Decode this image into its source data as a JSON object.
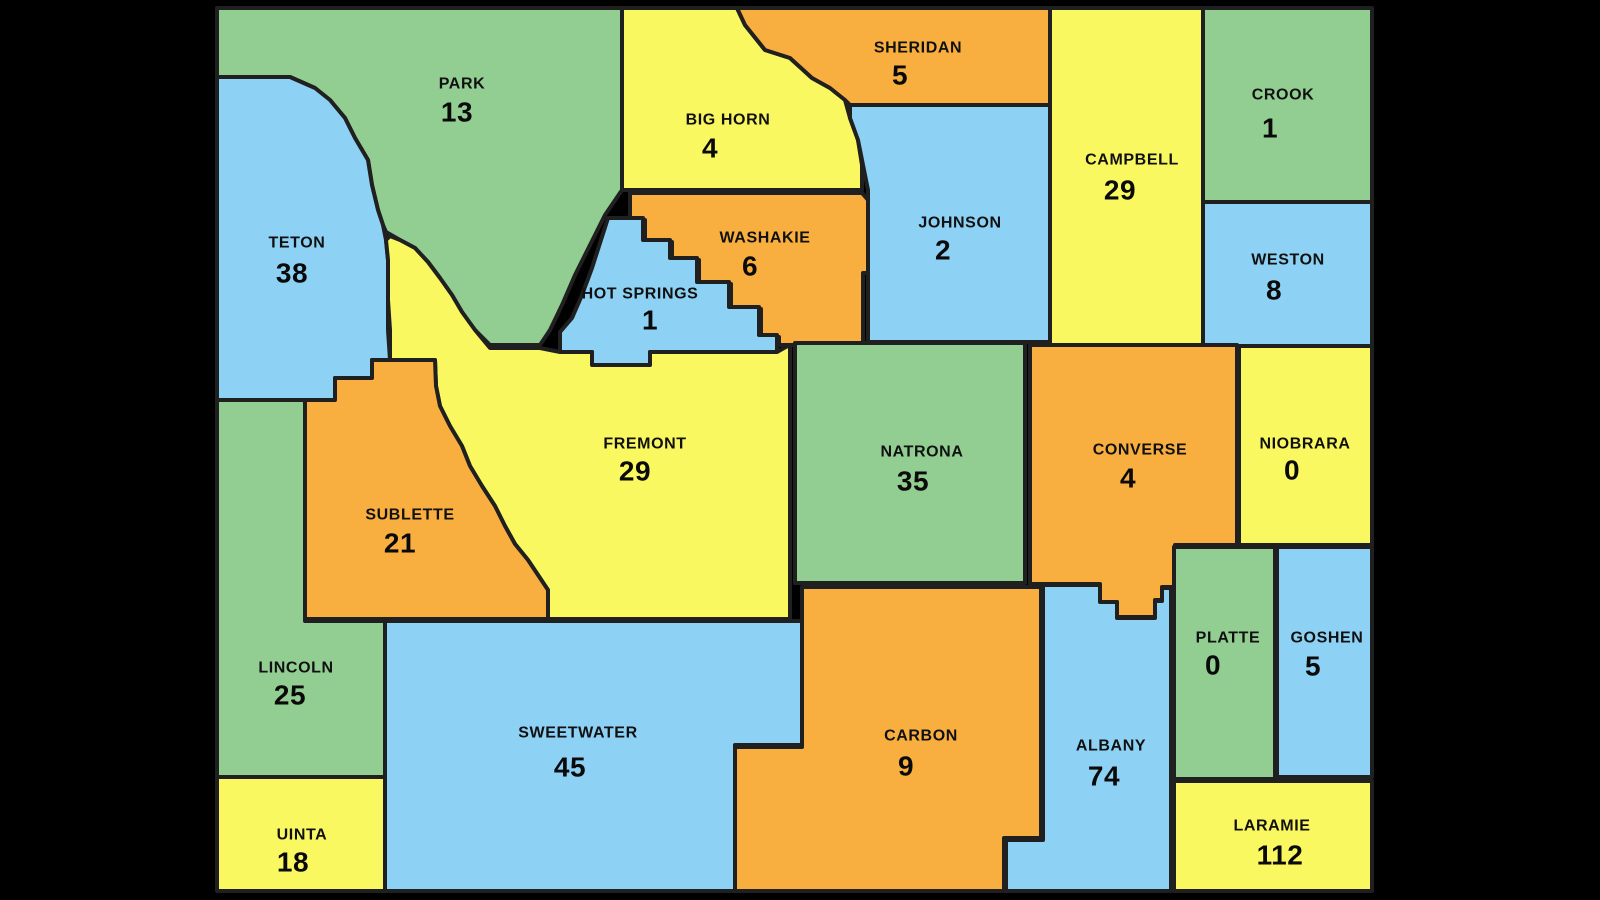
{
  "map": {
    "region": "Wyoming county map",
    "palette": {
      "green": "#92CD92",
      "yellow": "#FAF860",
      "blue": "#8DD1F5",
      "orange": "#F9AF40",
      "border": "#202020",
      "background": "#000000",
      "label": "#101010"
    },
    "counties": [
      {
        "id": "park",
        "name": "PARK",
        "value": "13",
        "color": "green"
      },
      {
        "id": "big-horn",
        "name": "BIG HORN",
        "value": "4",
        "color": "yellow"
      },
      {
        "id": "sheridan",
        "name": "SHERIDAN",
        "value": "5",
        "color": "orange"
      },
      {
        "id": "campbell",
        "name": "CAMPBELL",
        "value": "29",
        "color": "yellow"
      },
      {
        "id": "crook",
        "name": "CROOK",
        "value": "1",
        "color": "green"
      },
      {
        "id": "teton",
        "name": "TETON",
        "value": "38",
        "color": "blue"
      },
      {
        "id": "washakie",
        "name": "WASHAKIE",
        "value": "6",
        "color": "orange"
      },
      {
        "id": "hot-springs",
        "name": "HOT SPRINGS",
        "value": "1",
        "color": "blue"
      },
      {
        "id": "johnson",
        "name": "JOHNSON",
        "value": "2",
        "color": "blue"
      },
      {
        "id": "weston",
        "name": "WESTON",
        "value": "8",
        "color": "blue"
      },
      {
        "id": "fremont",
        "name": "FREMONT",
        "value": "29",
        "color": "yellow"
      },
      {
        "id": "natrona",
        "name": "NATRONA",
        "value": "35",
        "color": "green"
      },
      {
        "id": "converse",
        "name": "CONVERSE",
        "value": "4",
        "color": "orange"
      },
      {
        "id": "niobrara",
        "name": "NIOBRARA",
        "value": "0",
        "color": "yellow"
      },
      {
        "id": "sublette",
        "name": "SUBLETTE",
        "value": "21",
        "color": "orange"
      },
      {
        "id": "lincoln",
        "name": "LINCOLN",
        "value": "25",
        "color": "green"
      },
      {
        "id": "sweetwater",
        "name": "SWEETWATER",
        "value": "45",
        "color": "blue"
      },
      {
        "id": "carbon",
        "name": "CARBON",
        "value": "9",
        "color": "orange"
      },
      {
        "id": "albany",
        "name": "ALBANY",
        "value": "74",
        "color": "blue"
      },
      {
        "id": "platte",
        "name": "PLATTE",
        "value": "0",
        "color": "green"
      },
      {
        "id": "goshen",
        "name": "GOSHEN",
        "value": "5",
        "color": "blue"
      },
      {
        "id": "uinta",
        "name": "UINTA",
        "value": "18",
        "color": "yellow"
      },
      {
        "id": "laramie",
        "name": "LARAMIE",
        "value": "112",
        "color": "yellow"
      }
    ]
  }
}
